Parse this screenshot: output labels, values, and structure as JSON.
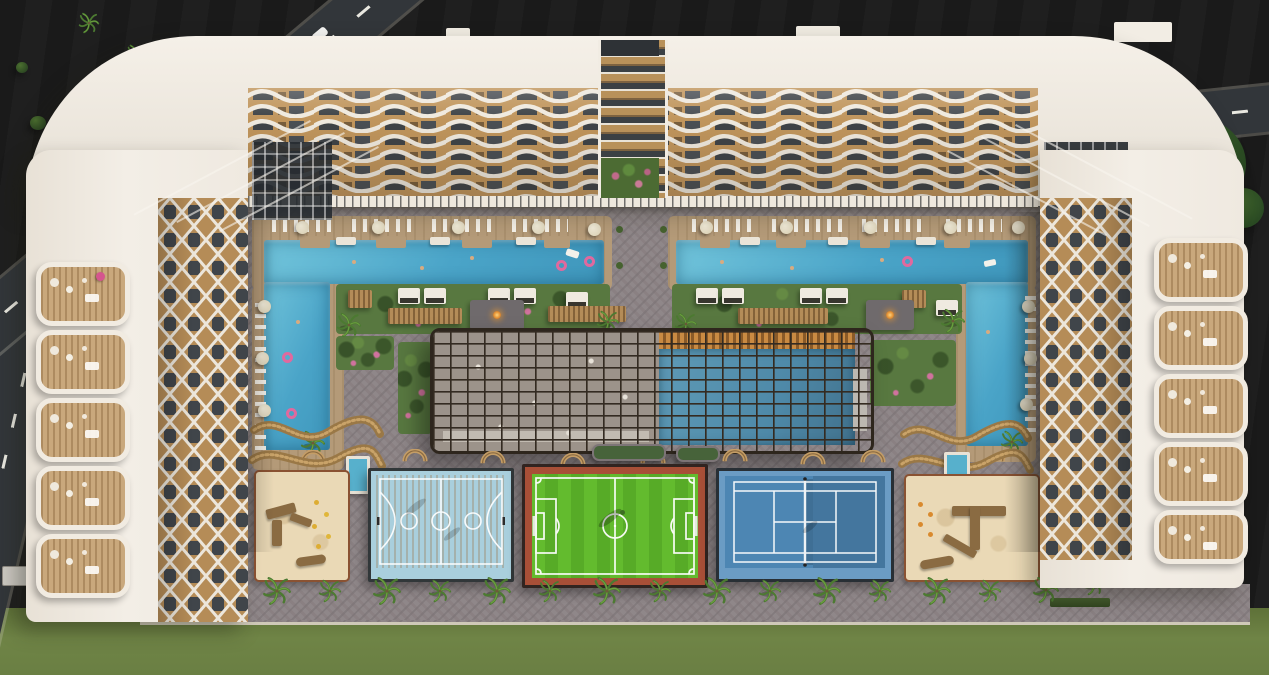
{
  "scene": {
    "type": "aerial-3d-architectural-render",
    "subject": "Top-down aerial render of a U-shaped residential resort complex with twin pools, lattice canopy, sports courts, playgrounds and palm-lined promenade"
  },
  "labels": {
    "scene": "Aerial 3D render of U-shaped residential resort complex",
    "lawn": "Surrounding lawn",
    "road_nw": "Access road north-west",
    "road_w": "Access road west",
    "road_e": "Access road east",
    "car": "White car on access road",
    "top_wing": "North wing with wave-pattern balconies",
    "west_wing": "West wing with lattice facade and terraces",
    "east_wing": "East wing with lattice facade and terraces",
    "atrium": "Central atrium with balcony garden",
    "arcade": "Ground-floor arcade walkway",
    "courtyard": "Landscaped courtyard",
    "pool_left": "West resort pool with sun deck",
    "pool_right": "East resort pool with sun deck",
    "garden_w": "West cabana garden",
    "garden_e": "East cabana garden",
    "canopy": "Central lattice canopy with semi-covered pool and lounge",
    "basketball": "Basketball court",
    "football": "Mini football pitch",
    "tennis": "Tennis court",
    "playground_w": "West sand playground",
    "playground_e": "East sand playground",
    "promenade": "Palm-lined promenade",
    "kids_pool": "Plunge pool",
    "fire_lounge": "Fire-pit lounge"
  },
  "palette": {
    "lawn": "#7b8e4c",
    "lawnDeep": "#64773c",
    "road": "#32363a",
    "roadLine": "#e9e8e0",
    "roofWhite": "#f2ede4",
    "roofShade": "#e0d9cd",
    "facadeTan": "#c0955c",
    "facadeDark": "#3e4347",
    "facadeWhite": "#efe9de",
    "paver": "#8f8789",
    "deck": "#b49a78",
    "poolBlue": "#5cb3d1",
    "poolDeep": "#3f97bc",
    "canopyPool": "#4e89a8",
    "garden": "#587840",
    "hedge": "#3c5530",
    "palm": "#4c7a31",
    "canopy": "#342b21",
    "basketball": "#dca55f",
    "apron": "#a9cfdd",
    "pitch": "#63bb2e",
    "pitchDark": "#57ab27",
    "pitchBorder": "#a84f37",
    "tennis": "#4d86b3",
    "tennisBand": "#6b9cc4",
    "fence": "#262626",
    "sand": "#ead9b6",
    "sandEdge": "#8a5232",
    "wood": "#a9834f",
    "cabana": "#efeae0",
    "parasol": "#d9cfb2",
    "flower": "#d1729e",
    "float": "#e0699e",
    "fire": "#e08a2e",
    "tree": "#31512a"
  }
}
